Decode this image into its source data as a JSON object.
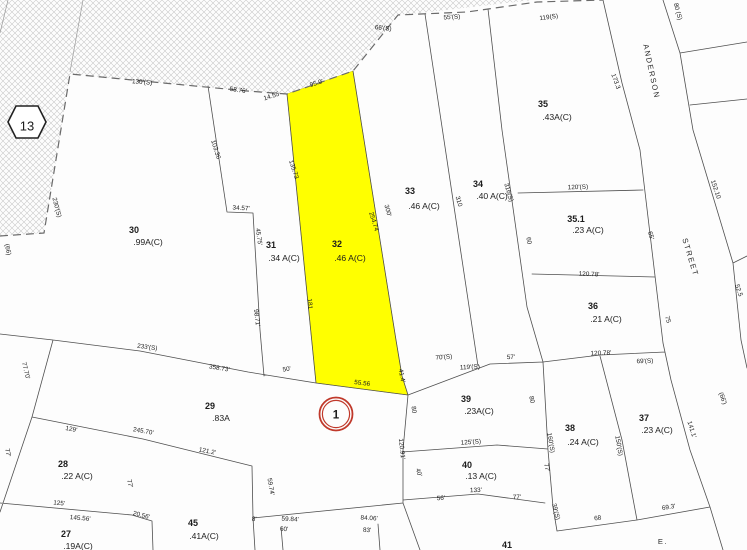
{
  "map": {
    "colors": {
      "highlight": "#ffff00",
      "route_ring": "#c0392b",
      "route_text": "#cc5a1e",
      "hatch": "#c9c9c9",
      "line": "#4f4f4f"
    },
    "sheet_badge": {
      "label": "13"
    },
    "route_marker": {
      "label": "1"
    },
    "highlight_parcel_id": "32",
    "streets": [
      {
        "text": "ANDERSON",
        "x": 649,
        "y": 72,
        "rot": 78
      },
      {
        "text": "STREET",
        "x": 688,
        "y": 258,
        "rot": 73
      },
      {
        "text": "E.",
        "x": 663,
        "y": 544,
        "rot": 0
      }
    ],
    "parcels": [
      {
        "num": "30",
        "area": ".99A(C)",
        "nx": 134,
        "ny": 233,
        "ax": 148,
        "ay": 245
      },
      {
        "num": "31",
        "area": ".34 A(C)",
        "nx": 271,
        "ny": 248,
        "ax": 284,
        "ay": 261
      },
      {
        "num": "32",
        "area": ".46 A(C)",
        "nx": 337,
        "ny": 247,
        "ax": 350,
        "ay": 261
      },
      {
        "num": "33",
        "area": ".46 A(C)",
        "nx": 410,
        "ny": 194,
        "ax": 424,
        "ay": 209
      },
      {
        "num": "34",
        "area": ".40 A(C)",
        "nx": 478,
        "ny": 187,
        "ax": 492,
        "ay": 199
      },
      {
        "num": "35",
        "area": ".43A(C)",
        "nx": 543,
        "ny": 107,
        "ax": 557,
        "ay": 120
      },
      {
        "num": "35.1",
        "area": ".23 A(C)",
        "nx": 576,
        "ny": 222,
        "ax": 588,
        "ay": 233
      },
      {
        "num": "36",
        "area": ".21 A(C)",
        "nx": 593,
        "ny": 309,
        "ax": 606,
        "ay": 322
      },
      {
        "num": "37",
        "area": ".23 A(C)",
        "nx": 644,
        "ny": 421,
        "ax": 657,
        "ay": 433
      },
      {
        "num": "38",
        "area": ".24 A(C)",
        "nx": 570,
        "ny": 431,
        "ax": 583,
        "ay": 445
      },
      {
        "num": "39",
        "area": ".23A(C)",
        "nx": 466,
        "ny": 402,
        "ax": 479,
        "ay": 414
      },
      {
        "num": "40",
        "area": ".13 A(C)",
        "nx": 467,
        "ny": 468,
        "ax": 481,
        "ay": 479
      },
      {
        "num": "41",
        "area": "",
        "nx": 507,
        "ny": 548,
        "ax": 507,
        "ay": 560
      },
      {
        "num": "29",
        "area": ".83A",
        "nx": 210,
        "ny": 409,
        "ax": 221,
        "ay": 421
      },
      {
        "num": "28",
        "area": ".22 A(C)",
        "nx": 63,
        "ny": 467,
        "ax": 77,
        "ay": 479
      },
      {
        "num": "27",
        "area": ".19A(C)",
        "nx": 66,
        "ny": 537,
        "ax": 78,
        "ay": 549
      },
      {
        "num": "45",
        "area": ".41A(C)",
        "nx": 193,
        "ny": 526,
        "ax": 204,
        "ay": 539
      }
    ],
    "dimensions": [
      {
        "text": "130'(S)",
        "x": 142,
        "y": 84,
        "rot": 4
      },
      {
        "text": "58.76'",
        "x": 238,
        "y": 92,
        "rot": 8
      },
      {
        "text": "14.55",
        "x": 272,
        "y": 98,
        "rot": -18
      },
      {
        "text": "95.9'",
        "x": 317,
        "y": 85,
        "rot": -17
      },
      {
        "text": "66'(S)",
        "x": 383,
        "y": 30,
        "rot": 6
      },
      {
        "text": "55'(S)",
        "x": 452,
        "y": 19,
        "rot": -3
      },
      {
        "text": "119(S)",
        "x": 549,
        "y": 19,
        "rot": -8
      },
      {
        "text": "80 (S)",
        "x": 676,
        "y": 12,
        "rot": 75
      },
      {
        "text": "173.3",
        "x": 614,
        "y": 82,
        "rot": 70
      },
      {
        "text": "103.36",
        "x": 214,
        "y": 150,
        "rot": 73
      },
      {
        "text": "230'(S)",
        "x": 55,
        "y": 208,
        "rot": 75
      },
      {
        "text": "(66)",
        "x": 6,
        "y": 250,
        "rot": 78
      },
      {
        "text": "34.57'",
        "x": 241,
        "y": 210,
        "rot": 3
      },
      {
        "text": "45.75'",
        "x": 257,
        "y": 237,
        "rot": 82
      },
      {
        "text": "135.73",
        "x": 292,
        "y": 170,
        "rot": 72
      },
      {
        "text": "310",
        "x": 457,
        "y": 202,
        "rot": 73
      },
      {
        "text": "316(S)",
        "x": 507,
        "y": 193,
        "rot": 73
      },
      {
        "text": "300'",
        "x": 386,
        "y": 211,
        "rot": 74
      },
      {
        "text": "254.74",
        "x": 372,
        "y": 222,
        "rot": 73
      },
      {
        "text": "120'(S)",
        "x": 578,
        "y": 189,
        "rot": -2
      },
      {
        "text": "60",
        "x": 527,
        "y": 241,
        "rot": 80
      },
      {
        "text": "65'",
        "x": 649,
        "y": 236,
        "rot": 74
      },
      {
        "text": "120.78'",
        "x": 589,
        "y": 276,
        "rot": 2
      },
      {
        "text": "75",
        "x": 666,
        "y": 320,
        "rot": 74
      },
      {
        "text": "152.10",
        "x": 714,
        "y": 190,
        "rot": 71
      },
      {
        "text": "52.5",
        "x": 737,
        "y": 291,
        "rot": 71
      },
      {
        "text": "181",
        "x": 308,
        "y": 304,
        "rot": 85
      },
      {
        "text": "98.71'",
        "x": 255,
        "y": 318,
        "rot": 83
      },
      {
        "text": "50'",
        "x": 287,
        "y": 371,
        "rot": -8
      },
      {
        "text": "233'(S)",
        "x": 147,
        "y": 349,
        "rot": 8
      },
      {
        "text": "358.73'",
        "x": 219,
        "y": 370,
        "rot": 9
      },
      {
        "text": "77.70'",
        "x": 24,
        "y": 371,
        "rot": 76
      },
      {
        "text": "77'",
        "x": 6,
        "y": 453,
        "rot": 80
      },
      {
        "text": "129'",
        "x": 71,
        "y": 431,
        "rot": 11
      },
      {
        "text": "245.70'",
        "x": 143,
        "y": 433,
        "rot": 10
      },
      {
        "text": "121.2'",
        "x": 207,
        "y": 453,
        "rot": 11
      },
      {
        "text": "125'",
        "x": 59,
        "y": 505,
        "rot": 5
      },
      {
        "text": "145.56'",
        "x": 80,
        "y": 520,
        "rot": 5
      },
      {
        "text": "20.56'",
        "x": 141,
        "y": 517,
        "rot": 14
      },
      {
        "text": "77'",
        "x": 128,
        "y": 484,
        "rot": 78
      },
      {
        "text": "8'",
        "x": 254,
        "y": 521,
        "rot": 4
      },
      {
        "text": "59.84'",
        "x": 290,
        "y": 521,
        "rot": 3
      },
      {
        "text": "60'",
        "x": 284,
        "y": 531,
        "rot": 3
      },
      {
        "text": "84.06'",
        "x": 369,
        "y": 520,
        "rot": 3
      },
      {
        "text": "83'",
        "x": 367,
        "y": 532,
        "rot": 3
      },
      {
        "text": "59.74'",
        "x": 269,
        "y": 487,
        "rot": 80
      },
      {
        "text": "55.56",
        "x": 362,
        "y": 385,
        "rot": 7
      },
      {
        "text": "41.4'",
        "x": 400,
        "y": 376,
        "rot": 80
      },
      {
        "text": "80",
        "x": 412,
        "y": 410,
        "rot": 82
      },
      {
        "text": "120.91'",
        "x": 400,
        "y": 449,
        "rot": 84
      },
      {
        "text": "40'",
        "x": 417,
        "y": 473,
        "rot": 72
      },
      {
        "text": "70'(S)",
        "x": 444,
        "y": 359,
        "rot": -4
      },
      {
        "text": "119'(S)",
        "x": 470,
        "y": 369,
        "rot": -3
      },
      {
        "text": "57'",
        "x": 511,
        "y": 359,
        "rot": -2
      },
      {
        "text": "120.78'",
        "x": 601,
        "y": 355,
        "rot": -2
      },
      {
        "text": "69'(S)",
        "x": 645,
        "y": 363,
        "rot": -2
      },
      {
        "text": "125'(S)",
        "x": 471,
        "y": 444,
        "rot": -4
      },
      {
        "text": "160'(S)",
        "x": 549,
        "y": 443,
        "rot": 80
      },
      {
        "text": "39'(S)",
        "x": 554,
        "y": 512,
        "rot": 76
      },
      {
        "text": "133'",
        "x": 476,
        "y": 492,
        "rot": -2
      },
      {
        "text": "56'",
        "x": 441,
        "y": 500,
        "rot": -3
      },
      {
        "text": "77'",
        "x": 517,
        "y": 499,
        "rot": -2
      },
      {
        "text": "77'",
        "x": 545,
        "y": 468,
        "rot": 78
      },
      {
        "text": "80",
        "x": 530,
        "y": 400,
        "rot": 78
      },
      {
        "text": "150'(S)",
        "x": 617,
        "y": 446,
        "rot": 80
      },
      {
        "text": "141.1'",
        "x": 690,
        "y": 430,
        "rot": 72
      },
      {
        "text": "(66')",
        "x": 721,
        "y": 399,
        "rot": 70
      },
      {
        "text": "68",
        "x": 598,
        "y": 520,
        "rot": -9
      },
      {
        "text": "69.3'",
        "x": 669,
        "y": 509,
        "rot": -9
      }
    ]
  }
}
